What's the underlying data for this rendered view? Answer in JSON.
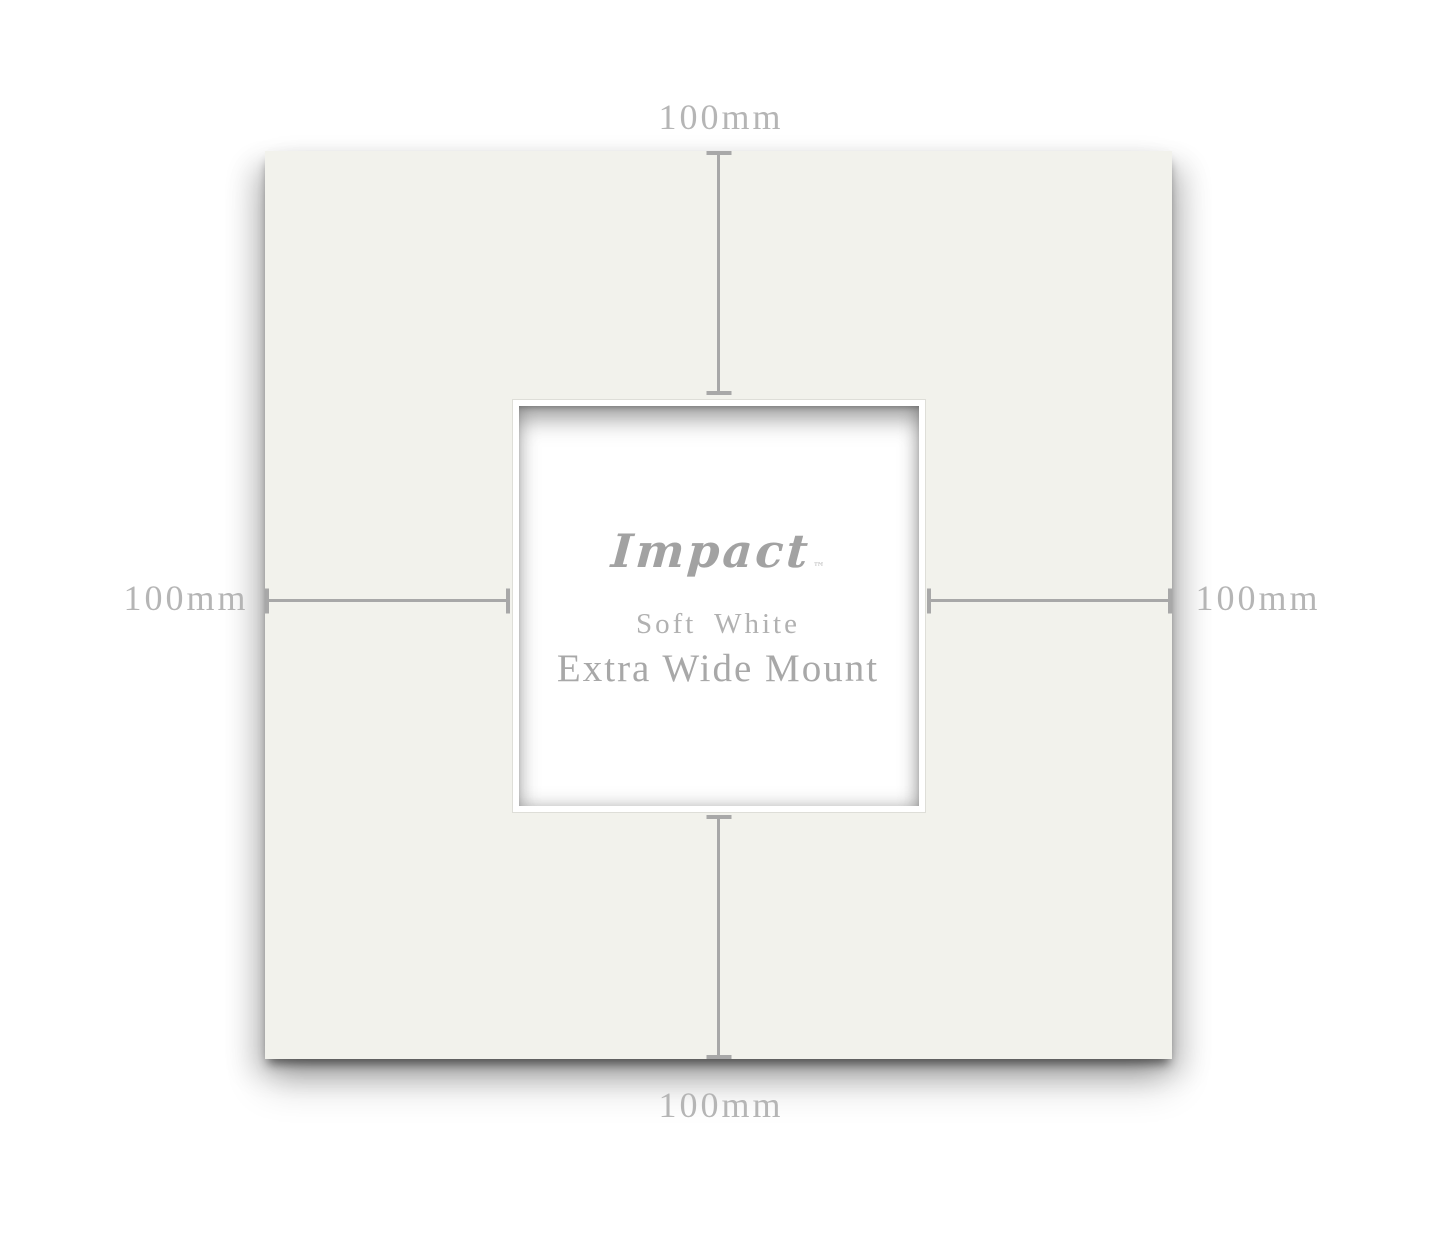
{
  "product": {
    "brand": "Impact",
    "trademark": "™",
    "color_name": "Soft White",
    "product_name": "Extra Wide Mount"
  },
  "dimensions": {
    "top": "100mm",
    "left": "100mm",
    "right": "100mm",
    "bottom": "100mm"
  },
  "colors": {
    "background": "#ffffff",
    "mount_surface": "#f2f2ec",
    "aperture_bevel": "#ffffff",
    "dimension_line": "#a8a8a8",
    "dimension_label_text": "#b5b5b5",
    "brand_text": "#a2a2a2",
    "product_text": "#a8a8a8"
  }
}
